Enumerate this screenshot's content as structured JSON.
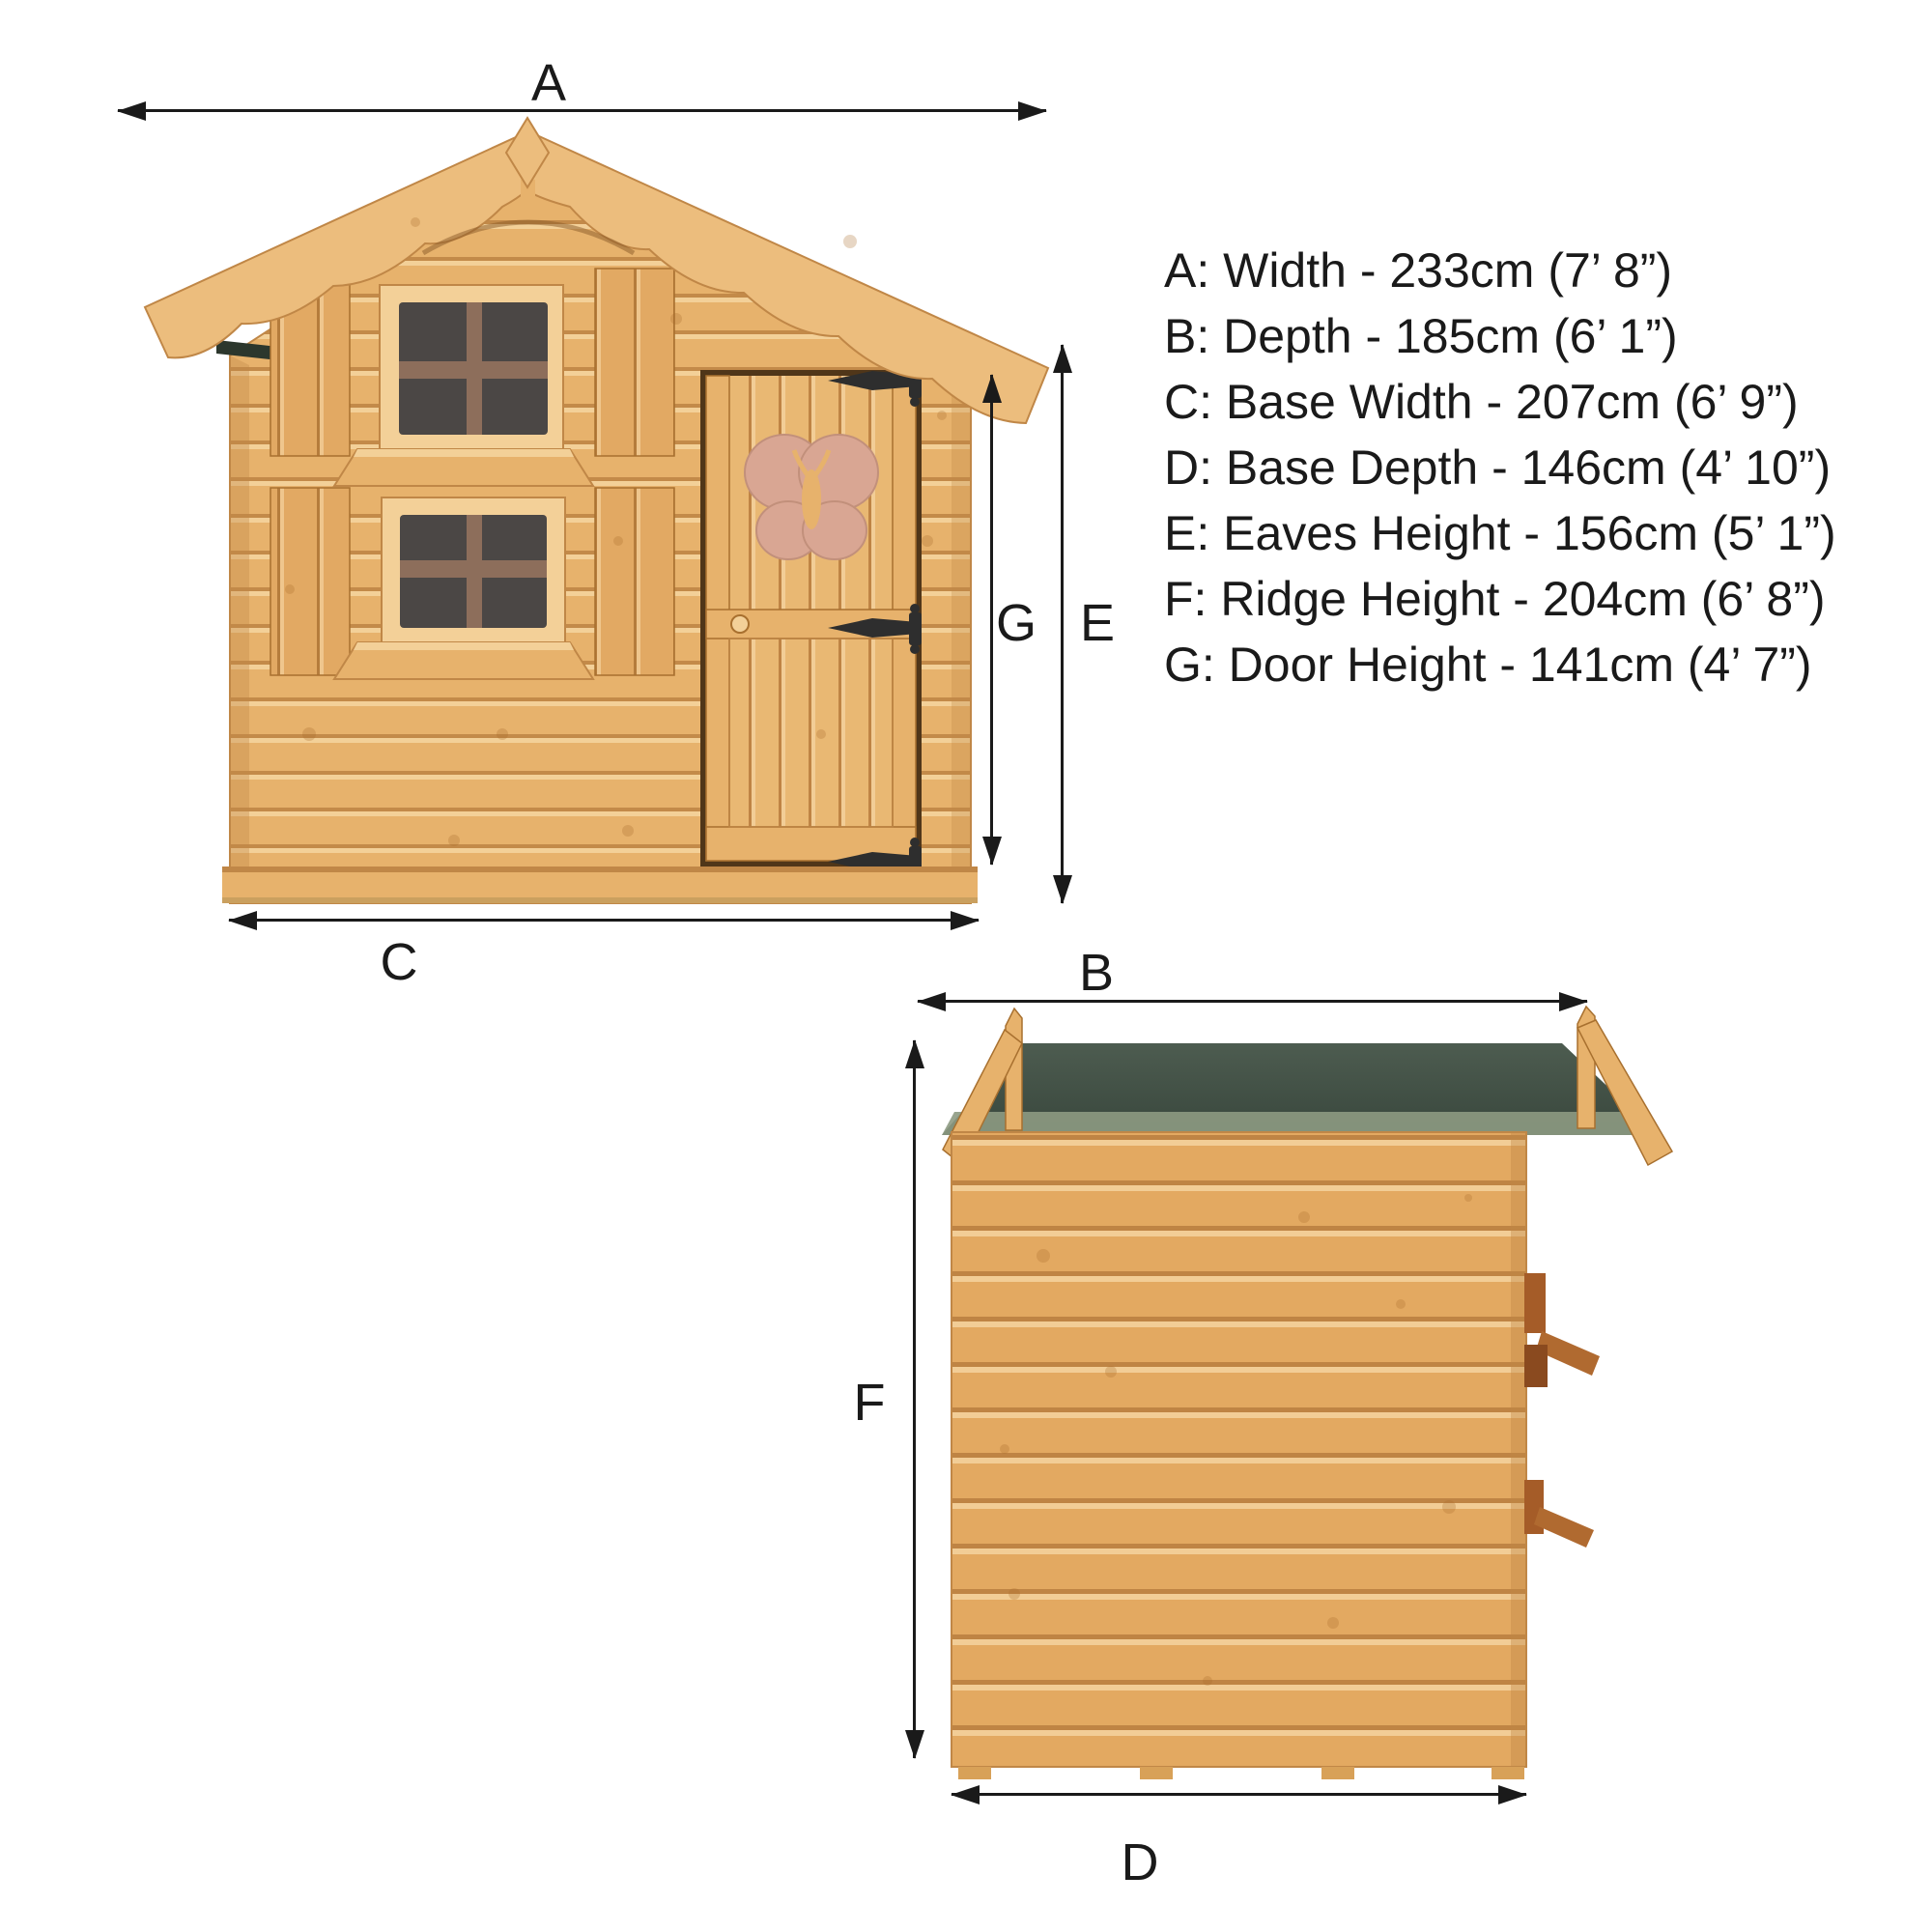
{
  "legend": {
    "items": [
      {
        "letter": "A",
        "dimension": "Width",
        "metric": "233cm",
        "imperial": "7’ 8”",
        "text": "A: Width - 233cm (7’ 8”)"
      },
      {
        "letter": "B",
        "dimension": "Depth",
        "metric": "185cm",
        "imperial": "6’ 1”",
        "text": "B: Depth - 185cm (6’ 1”)"
      },
      {
        "letter": "C",
        "dimension": "Base Width",
        "metric": "207cm",
        "imperial": "6’ 9”",
        "text": "C: Base Width - 207cm (6’ 9”)"
      },
      {
        "letter": "D",
        "dimension": "Base Depth",
        "metric": "146cm",
        "imperial": "4’ 10”",
        "text": "D: Base Depth - 146cm (4’ 10”)"
      },
      {
        "letter": "E",
        "dimension": "Eaves Height",
        "metric": "156cm",
        "imperial": "5’ 1”",
        "text": "E: Eaves Height - 156cm (5’ 1”)"
      },
      {
        "letter": "F",
        "dimension": "Ridge Height",
        "metric": "204cm",
        "imperial": "6’ 8”",
        "text": "F: Ridge Height - 204cm (6’ 8”)"
      },
      {
        "letter": "G",
        "dimension": "Door Height",
        "metric": "141cm",
        "imperial": "4’ 7”",
        "text": "G: Door Height - 141cm (4’ 7”)"
      }
    ]
  },
  "dimension_markers": {
    "A": "A",
    "B": "B",
    "C": "C",
    "D": "D",
    "E": "E",
    "F": "F",
    "G": "G"
  },
  "views": {
    "front": "front elevation",
    "side": "side elevation"
  },
  "colors": {
    "ink": "#1a1a1a",
    "wood": "#e7b26c",
    "wood-light": "#f3d098",
    "wood-dark": "#c08747",
    "roof-board": "#ecbd7d",
    "felt": "#41503f",
    "felt-edge": "#8d9a82",
    "glass": "#4b4745",
    "glazing": "#8d6e5b",
    "butterfly": "#d9a693",
    "hinge": "#2e2e2e",
    "bracket": "#a55c28"
  }
}
